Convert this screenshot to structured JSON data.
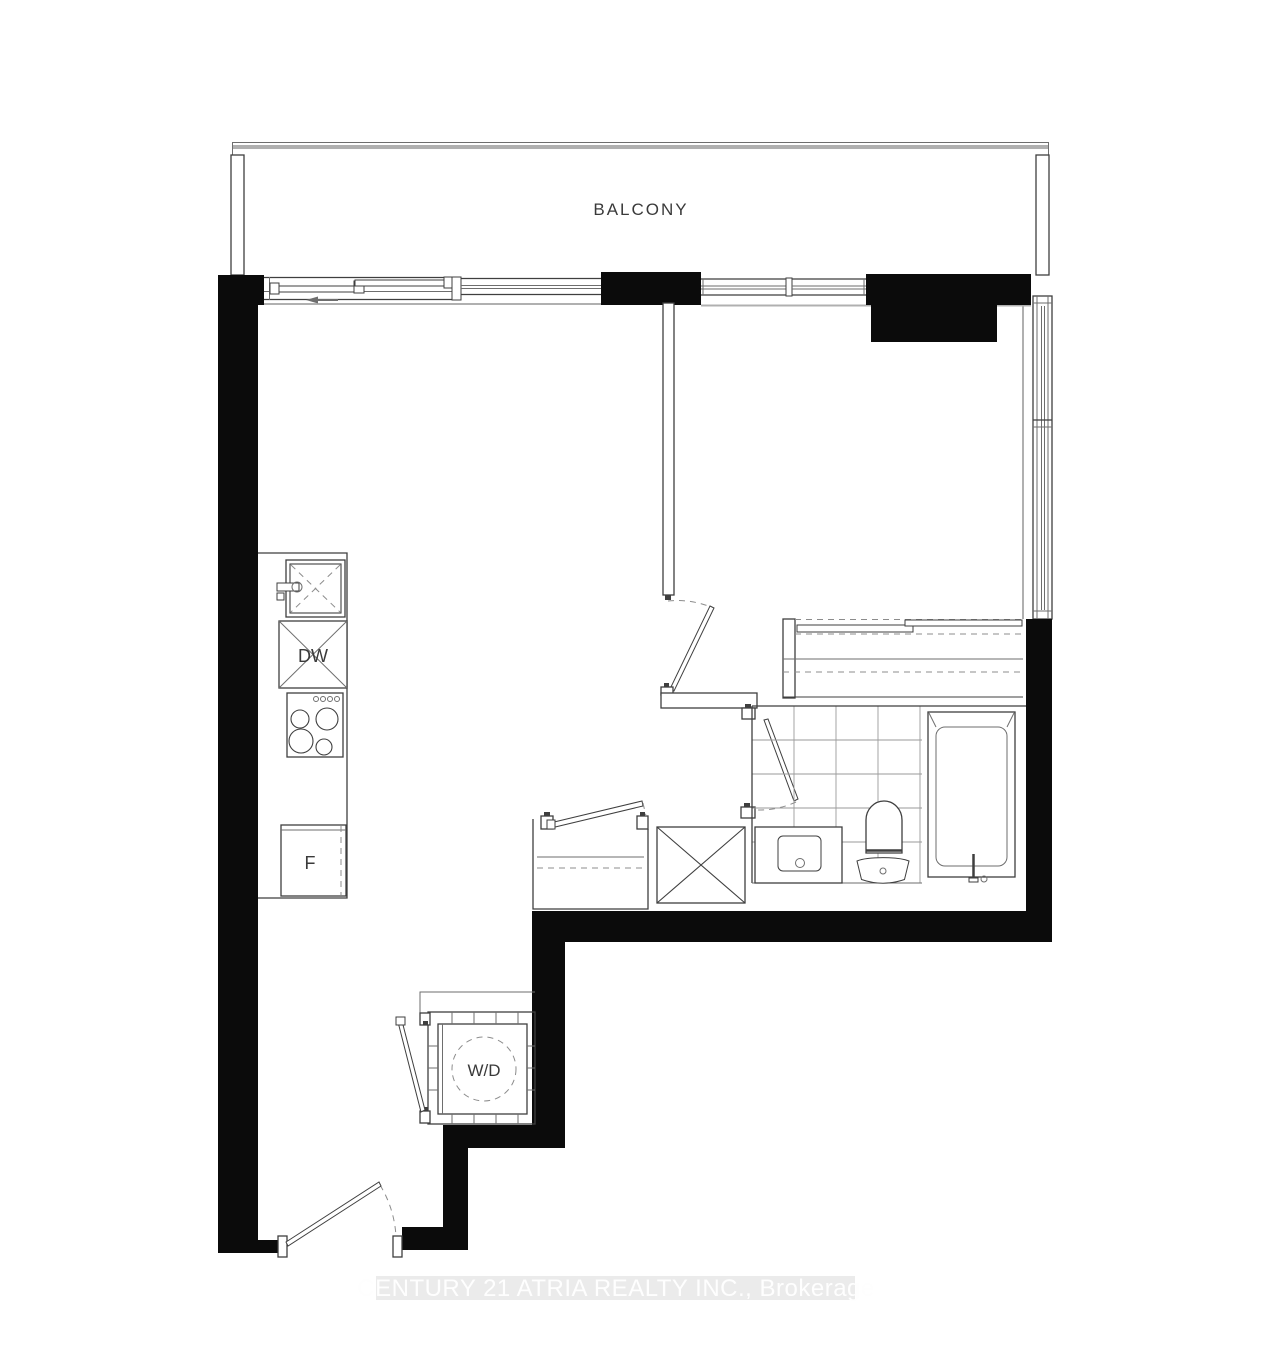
{
  "plan": {
    "balcony": {
      "label": "BALCONY"
    },
    "kitchen": {
      "dishwasher_label": "DW",
      "fridge_label": "F"
    },
    "laundry": {
      "washer_dryer_label": "W/D"
    },
    "watermark": {
      "text": "CENTURY 21 ATRIA REALTY INC., Brokerage"
    }
  },
  "colors": {
    "wall": "#0b0b0b",
    "line": "#3f3f3f",
    "thin_line": "#6e6e6e",
    "gray_face": "#b0b0b0",
    "tile_line": "#9a9a9a",
    "dash": "#8c8c8c",
    "label_text": "#3a3a3a",
    "watermark_bg": "#ebebeb",
    "watermark_text": "#fefefe"
  }
}
